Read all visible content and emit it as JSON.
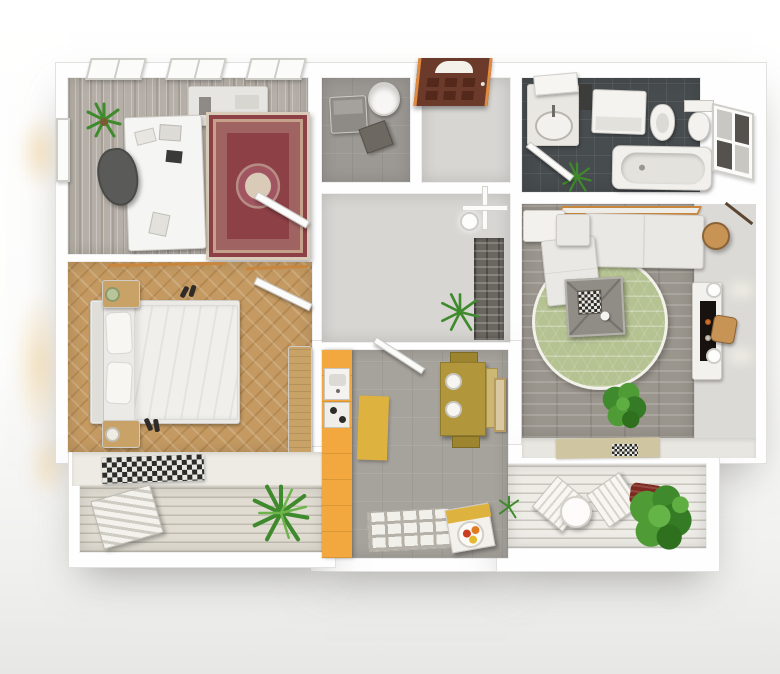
{
  "scene": {
    "type": "3d-floor-plan-top-view-render",
    "description": "Top-down 3D render of a one-bedroom apartment: office, bedroom, laundry room, entrance hall, bathroom, living room, kitchen and two balconies",
    "background": "#ffffff"
  },
  "palette": {
    "wall": "#fefefe",
    "wall_edge": "#dddbd6",
    "office_floor": "#b5afa7",
    "office_rug": "#8d4046",
    "bedroom_floor": "#c49a62",
    "bedroom_band": "#edebe4",
    "wood": "#c9a267",
    "deck_left": "#e0dcd2",
    "deck_right": "#eeece6",
    "storage_floor": "#9c9894",
    "hall_floor": "#d8d6d2",
    "stone_panel": "#6a6660",
    "front_door": "#6b3a2a",
    "bathroom_floor": "#474c4f",
    "living_floor": "#9a958d",
    "living_floor_right": "#dcdad6",
    "living_rug": "#b5c291",
    "living_area_rug": "#cfc5a0",
    "kitchen_floor": "#a6a29c",
    "kitchen_cabinets": "#f2a83e",
    "kitchen_mat": "#deb23e",
    "dining_table": "#b2963c",
    "shelf_wood": "#c8863e",
    "wood_accent": "#c89455",
    "sofa": "#e9e8e5",
    "dresser": "#e7e5e1",
    "chair_dark": "#5a5a58",
    "washer_gray": "#8e8b87",
    "plant_green": "#3f8a2c",
    "pot_red": "#7e2a20",
    "screen_dark": "#17120f",
    "glow_warm": "#f7e3be"
  },
  "rooms": [
    {
      "id": "office",
      "furniture": [
        "desk",
        "office-chair",
        "oriental-rug",
        "potted-plant",
        "dresser",
        "top-window",
        "top-window",
        "top-window",
        "side-window"
      ]
    },
    {
      "id": "bedroom",
      "furniture": [
        "double-bed",
        "nightstand-with-lamp",
        "nightstand-with-lamp",
        "wardrobe",
        "shoes",
        "shoes",
        "checkered-rug",
        "open-door"
      ]
    },
    {
      "id": "balcony-left",
      "furniture": [
        "lounge-chair",
        "palm-plant"
      ]
    },
    {
      "id": "laundry-room",
      "furniture": [
        "washing-machine",
        "laundry-basket",
        "storage-box"
      ]
    },
    {
      "id": "entrance-hall",
      "furniture": [
        "front-door",
        "ceiling-light",
        "potted-plant",
        "stone-accent-wall"
      ]
    },
    {
      "id": "bathroom",
      "furniture": [
        "sink-with-mirror",
        "washing-machine",
        "bidet",
        "toilet",
        "bathtub",
        "window",
        "plant",
        "open-door"
      ]
    },
    {
      "id": "living-room",
      "furniture": [
        "corner-sofa",
        "wall-shelf",
        "round-rug",
        "coffee-table-with-chessboard",
        "tv-fireplace-unit",
        "wall-sconce",
        "wall-sconce",
        "side-table",
        "arc-floor-lamp",
        "potted-plant",
        "area-rug",
        "cabinet"
      ]
    },
    {
      "id": "kitchen",
      "furniture": [
        "cabinet-run-with-sink-and-cooktop",
        "floor-mat",
        "dining-table",
        "chair",
        "chair",
        "plates",
        "serving-cart-with-fruit",
        "tile-mat",
        "wall-picture",
        "open-door"
      ]
    },
    {
      "id": "balcony-right",
      "furniture": [
        "folding-chair",
        "folding-chair",
        "round-table",
        "planter-pot",
        "bush-plant",
        "small-plant"
      ]
    }
  ]
}
